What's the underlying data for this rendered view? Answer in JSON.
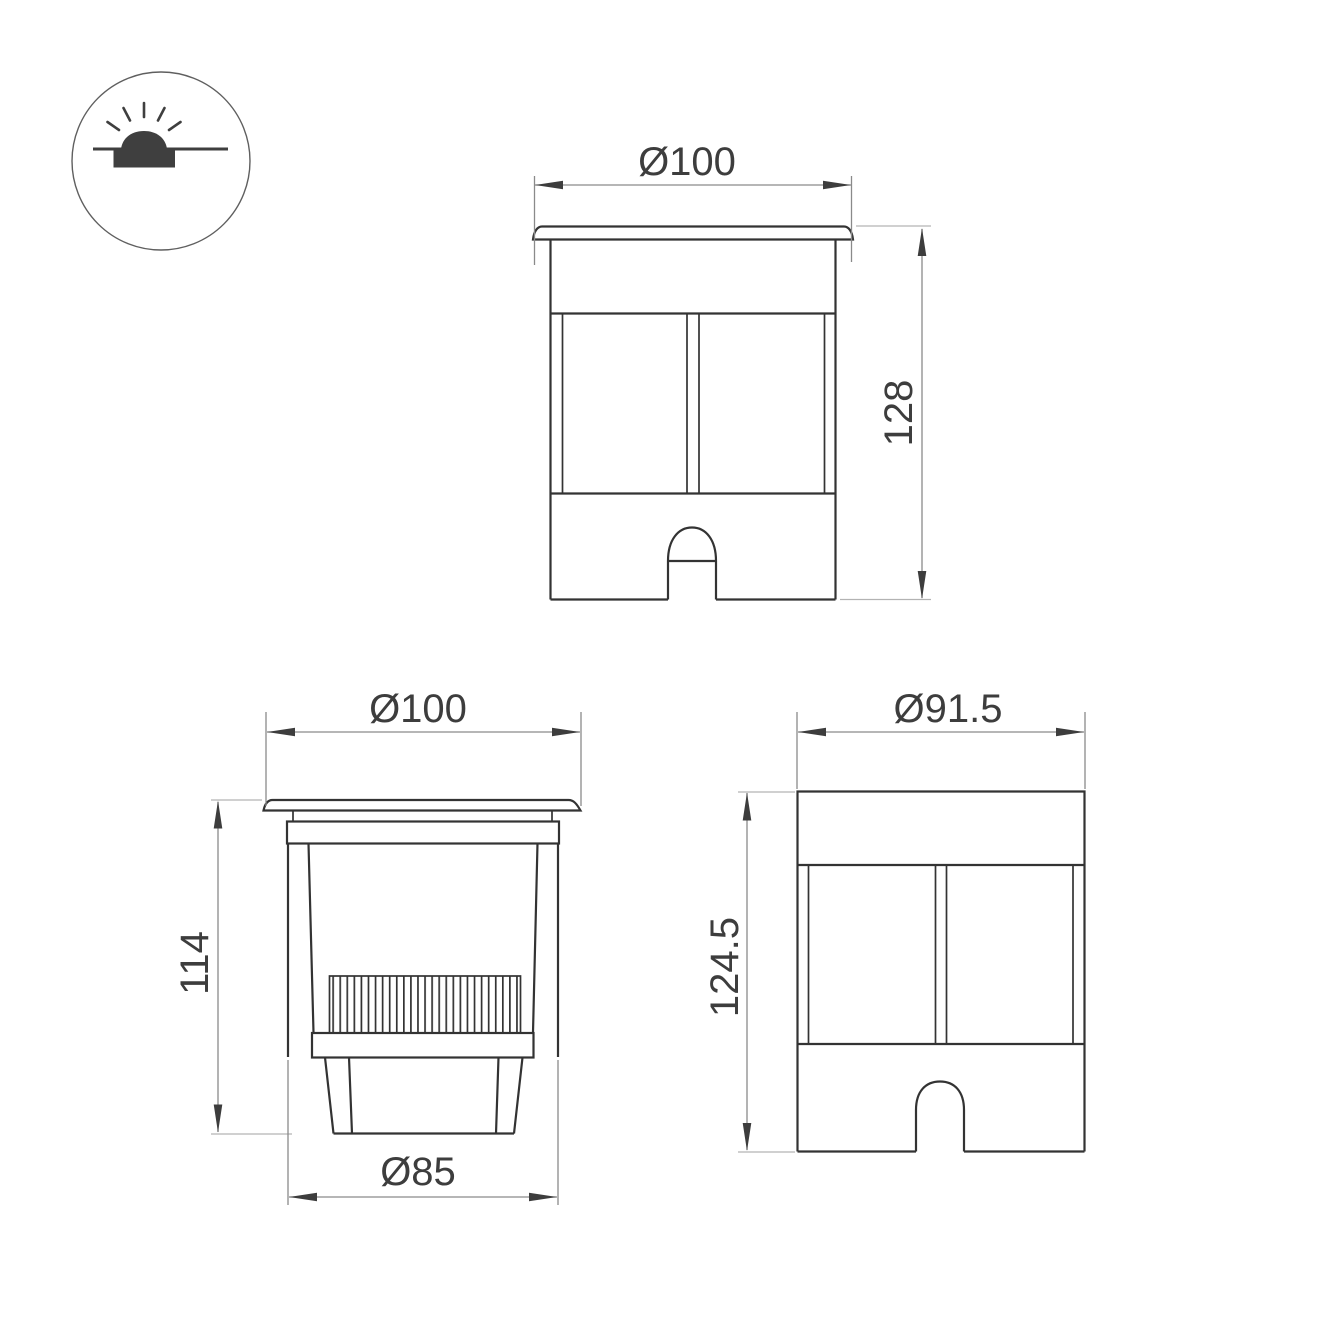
{
  "views": {
    "front": {
      "width": "Ø100",
      "height": "128"
    },
    "section": {
      "width": "Ø100",
      "height": "114",
      "bottom_width": "Ø85"
    },
    "side": {
      "width": "Ø91.5",
      "height": "124.5"
    }
  },
  "colors": {
    "outline": "#333333",
    "dim": "#8a8a8a",
    "ext": "#b3b3b3",
    "arrow": "#3d3d3d",
    "text": "#3d3d3d",
    "bg": "#ffffff"
  }
}
